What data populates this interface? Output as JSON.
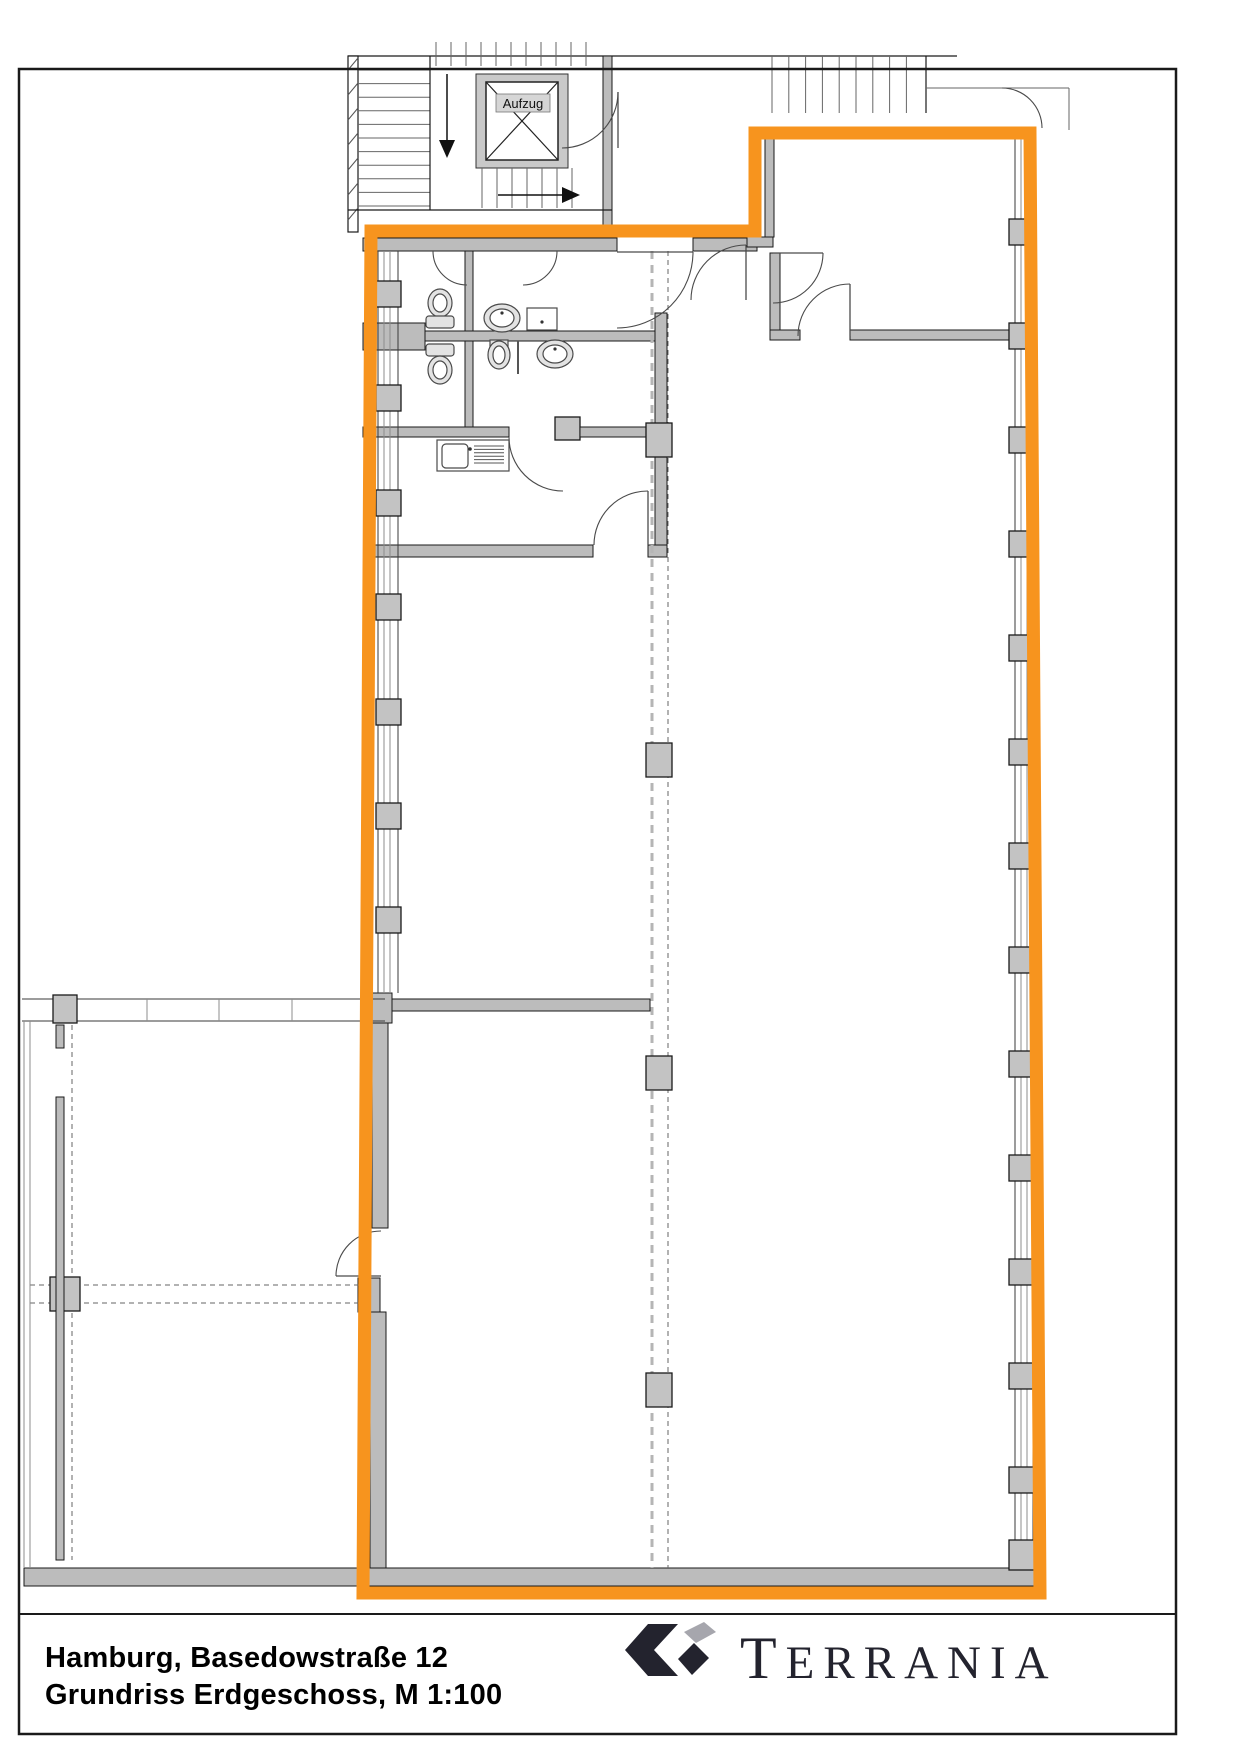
{
  "document": {
    "type": "floor-plan-sheet",
    "title_line1": "Hamburg, Basedowstraße 12",
    "title_line2": "Grundriss Erdgeschoss, M 1:100",
    "city": "Hamburg",
    "address": "Basedowstraße 12",
    "floor": "Erdgeschoss",
    "scale": "M 1:100"
  },
  "plan": {
    "elevator_label": "Aufzug",
    "highlighted_area": "rental unit outlined in orange",
    "features": [
      "stairwell",
      "elevator",
      "wc-toilets",
      "sinks",
      "urinal",
      "kitchenette",
      "window-facade-with-pillars",
      "column-grid-dashed-lines",
      "neighbor-unit-lower-left"
    ]
  },
  "branding": {
    "company": "TERRANIA"
  },
  "colors": {
    "accent": "#F7941E",
    "wall": "#BCBCBC",
    "line": "#1A1A1A",
    "dash_light": "#B5B5B5",
    "dash_dark": "#666666",
    "logo_dark": "#23232E",
    "logo_gray": "#A6A6AD"
  }
}
